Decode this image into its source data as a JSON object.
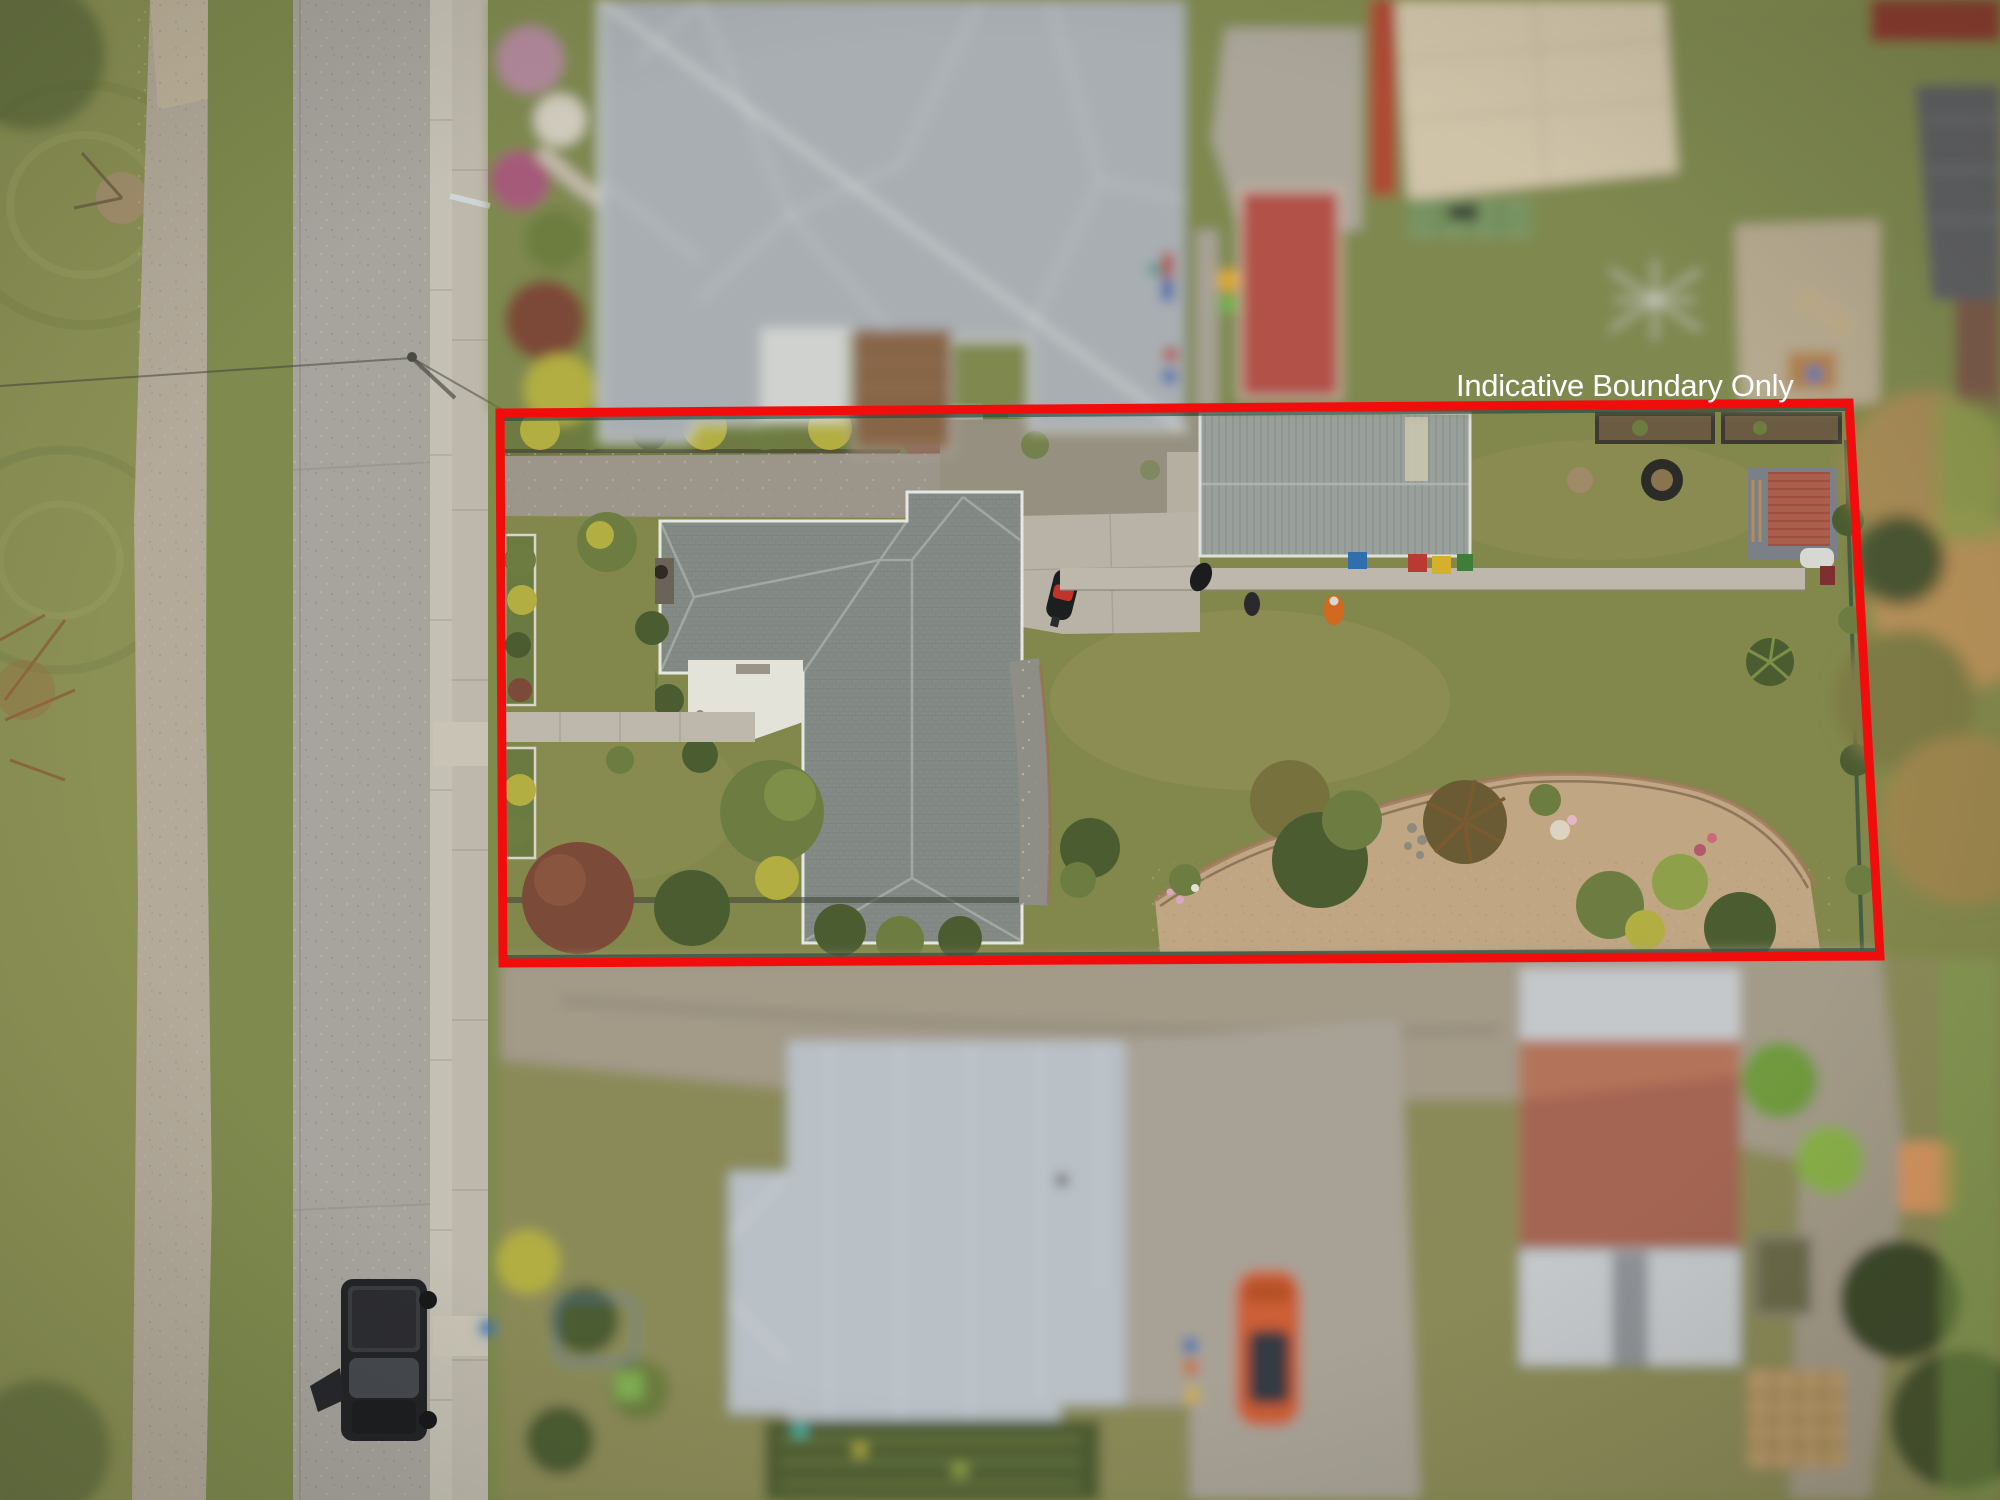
{
  "annotation": {
    "label": "Indicative Boundary Only"
  },
  "boundary": {
    "points": "500,413 1849,403 1880,956 503,963",
    "top_shadow": "500,419 1849,409",
    "bottom_shadow": "503,957 1880,950",
    "stroke_width": 9
  },
  "colors": {
    "boundary_red": "#f20d0d",
    "label_white": "#ffffff",
    "park_grass": "#8b9155",
    "park_grass_dark": "#79824b",
    "verge_grass": "#7e8a4e",
    "path_gravel": "#b3aa9a",
    "road_asphalt": "#a7a49e",
    "curb_concrete": "#c4c0b4",
    "footpath_concrete": "#bdb8ab",
    "lawn_olive": "#82884c",
    "lawn_light": "#949259",
    "drive_gravel": "#9c968a",
    "concrete_light": "#b8b3a6",
    "patio_white": "#e4e3da",
    "house_roof": "#848a86",
    "house_ridge": "#a6aba6",
    "gutter_white": "#e6e7e1",
    "garage_roof": "#9aa09c",
    "north_roof": "#a9aeb2",
    "bottom_roof": "#b9c0c6",
    "rust_roof": "#a95f4c",
    "silver_roof": "#c5c8cb",
    "beige_building": "#cfc3a8",
    "red_roof_small": "#b5524a",
    "deck_wood": "#8a6748",
    "dirt_garden": "#c1a683",
    "tree_dark": "#4c5c31",
    "tree_mid": "#6d7d41",
    "tree_yellow": "#b2ae42",
    "tree_maroon": "#7c4a38",
    "autumn_tree": "#a58a55",
    "fence_dark": "#25483d",
    "black_car": "#222326",
    "orange_car": "#cc5f35",
    "hivis_orange": "#d2691f",
    "bin_blue": "#2f6fae",
    "bin_red": "#b83a30",
    "bin_yellow": "#d4b12c",
    "bin_green": "#3e7d3a"
  }
}
